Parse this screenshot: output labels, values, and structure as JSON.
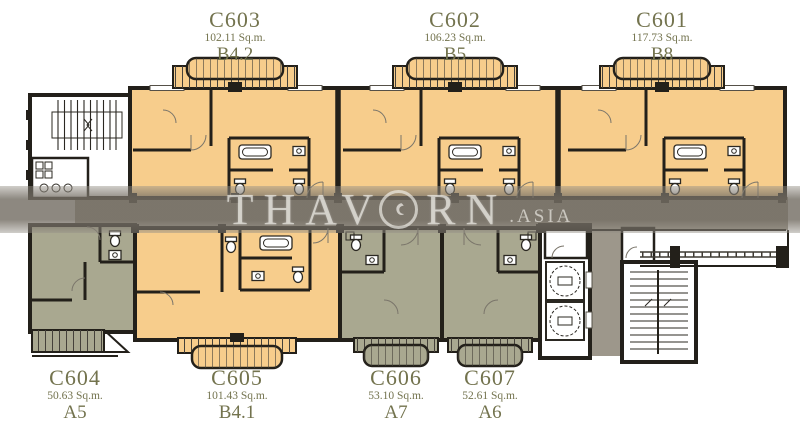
{
  "watermark": {
    "part1": "THAV",
    "part2": "RN",
    "suffix": ".ASIA"
  },
  "units": [
    {
      "id": "C603",
      "area": "102.11 Sq.m.",
      "type": "B4.2"
    },
    {
      "id": "C602",
      "area": "106.23 Sq.m.",
      "type": "B5"
    },
    {
      "id": "C601",
      "area": "117.73 Sq.m.",
      "type": "B8"
    },
    {
      "id": "C604",
      "area": "50.63 Sq.m.",
      "type": "A5"
    },
    {
      "id": "C605",
      "area": "101.43 Sq.m.",
      "type": "B4.1"
    },
    {
      "id": "C606",
      "area": "53.10 Sq.m.",
      "type": "A7"
    },
    {
      "id": "C607",
      "area": "52.61 Sq.m.",
      "type": "A6"
    }
  ],
  "colors": {
    "unit_orange": "#F7CD8C",
    "unit_green": "#A9A890",
    "wall": "#23201A",
    "corridor": "#9D978B",
    "label_text": "#73734E",
    "watermark_text": "#EAE8E2"
  }
}
